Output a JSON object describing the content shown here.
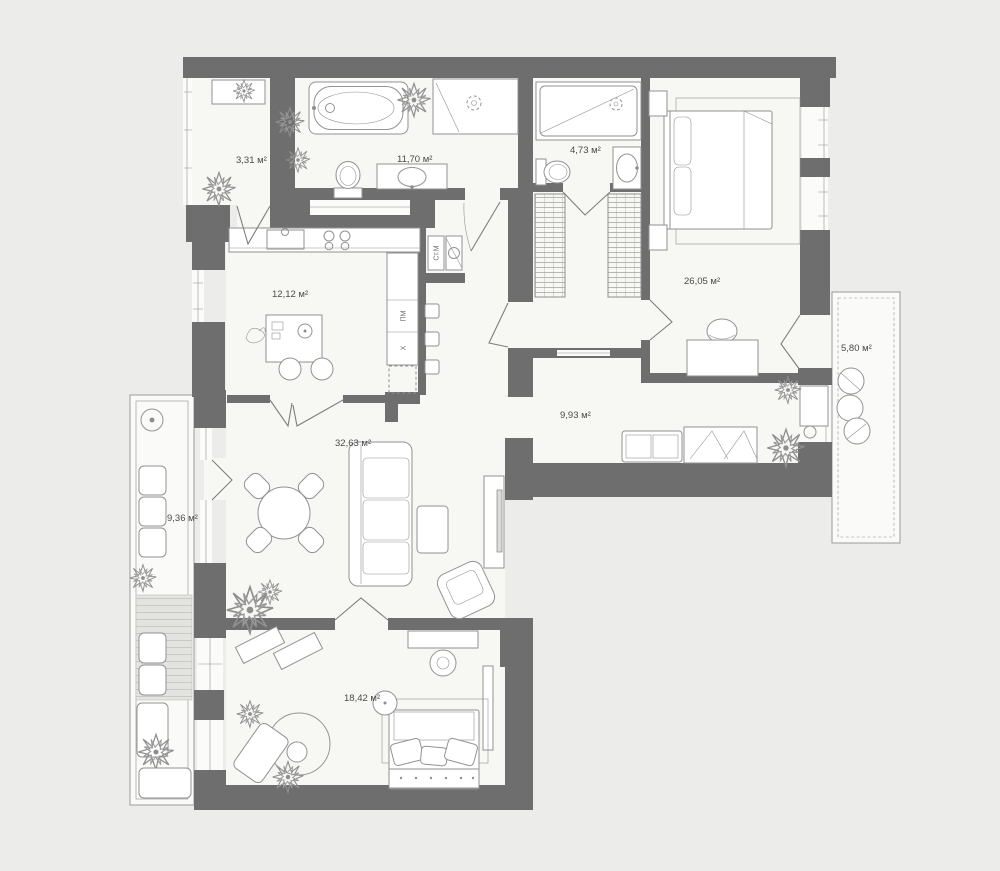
{
  "title": "apartment-floor-plan",
  "units": "м²",
  "rooms": [
    {
      "id": "utility",
      "label": "3,31 м²"
    },
    {
      "id": "bathroom",
      "label": "11,70 м²"
    },
    {
      "id": "shower-room",
      "label": "4,73 м²"
    },
    {
      "id": "master-bedroom",
      "label": "26,05 м²"
    },
    {
      "id": "kitchen",
      "label": "12,12 м²"
    },
    {
      "id": "balcony-right",
      "label": "5,80 м²"
    },
    {
      "id": "hallway",
      "label": "9,93 м²"
    },
    {
      "id": "living-room",
      "label": "32,63 м²"
    },
    {
      "id": "balcony-left",
      "label": "9,36 м²"
    },
    {
      "id": "bedroom",
      "label": "18,42 м²"
    }
  ],
  "appliances": {
    "washer": "Ст.М",
    "dishwasher": "ПМ",
    "fridge": "Х"
  },
  "colors": {
    "background": "#ECECEA",
    "wall": "#6E6E6E",
    "floor": "#F7F7F4",
    "stroke": "#929292",
    "text": "#4A4A4A"
  }
}
